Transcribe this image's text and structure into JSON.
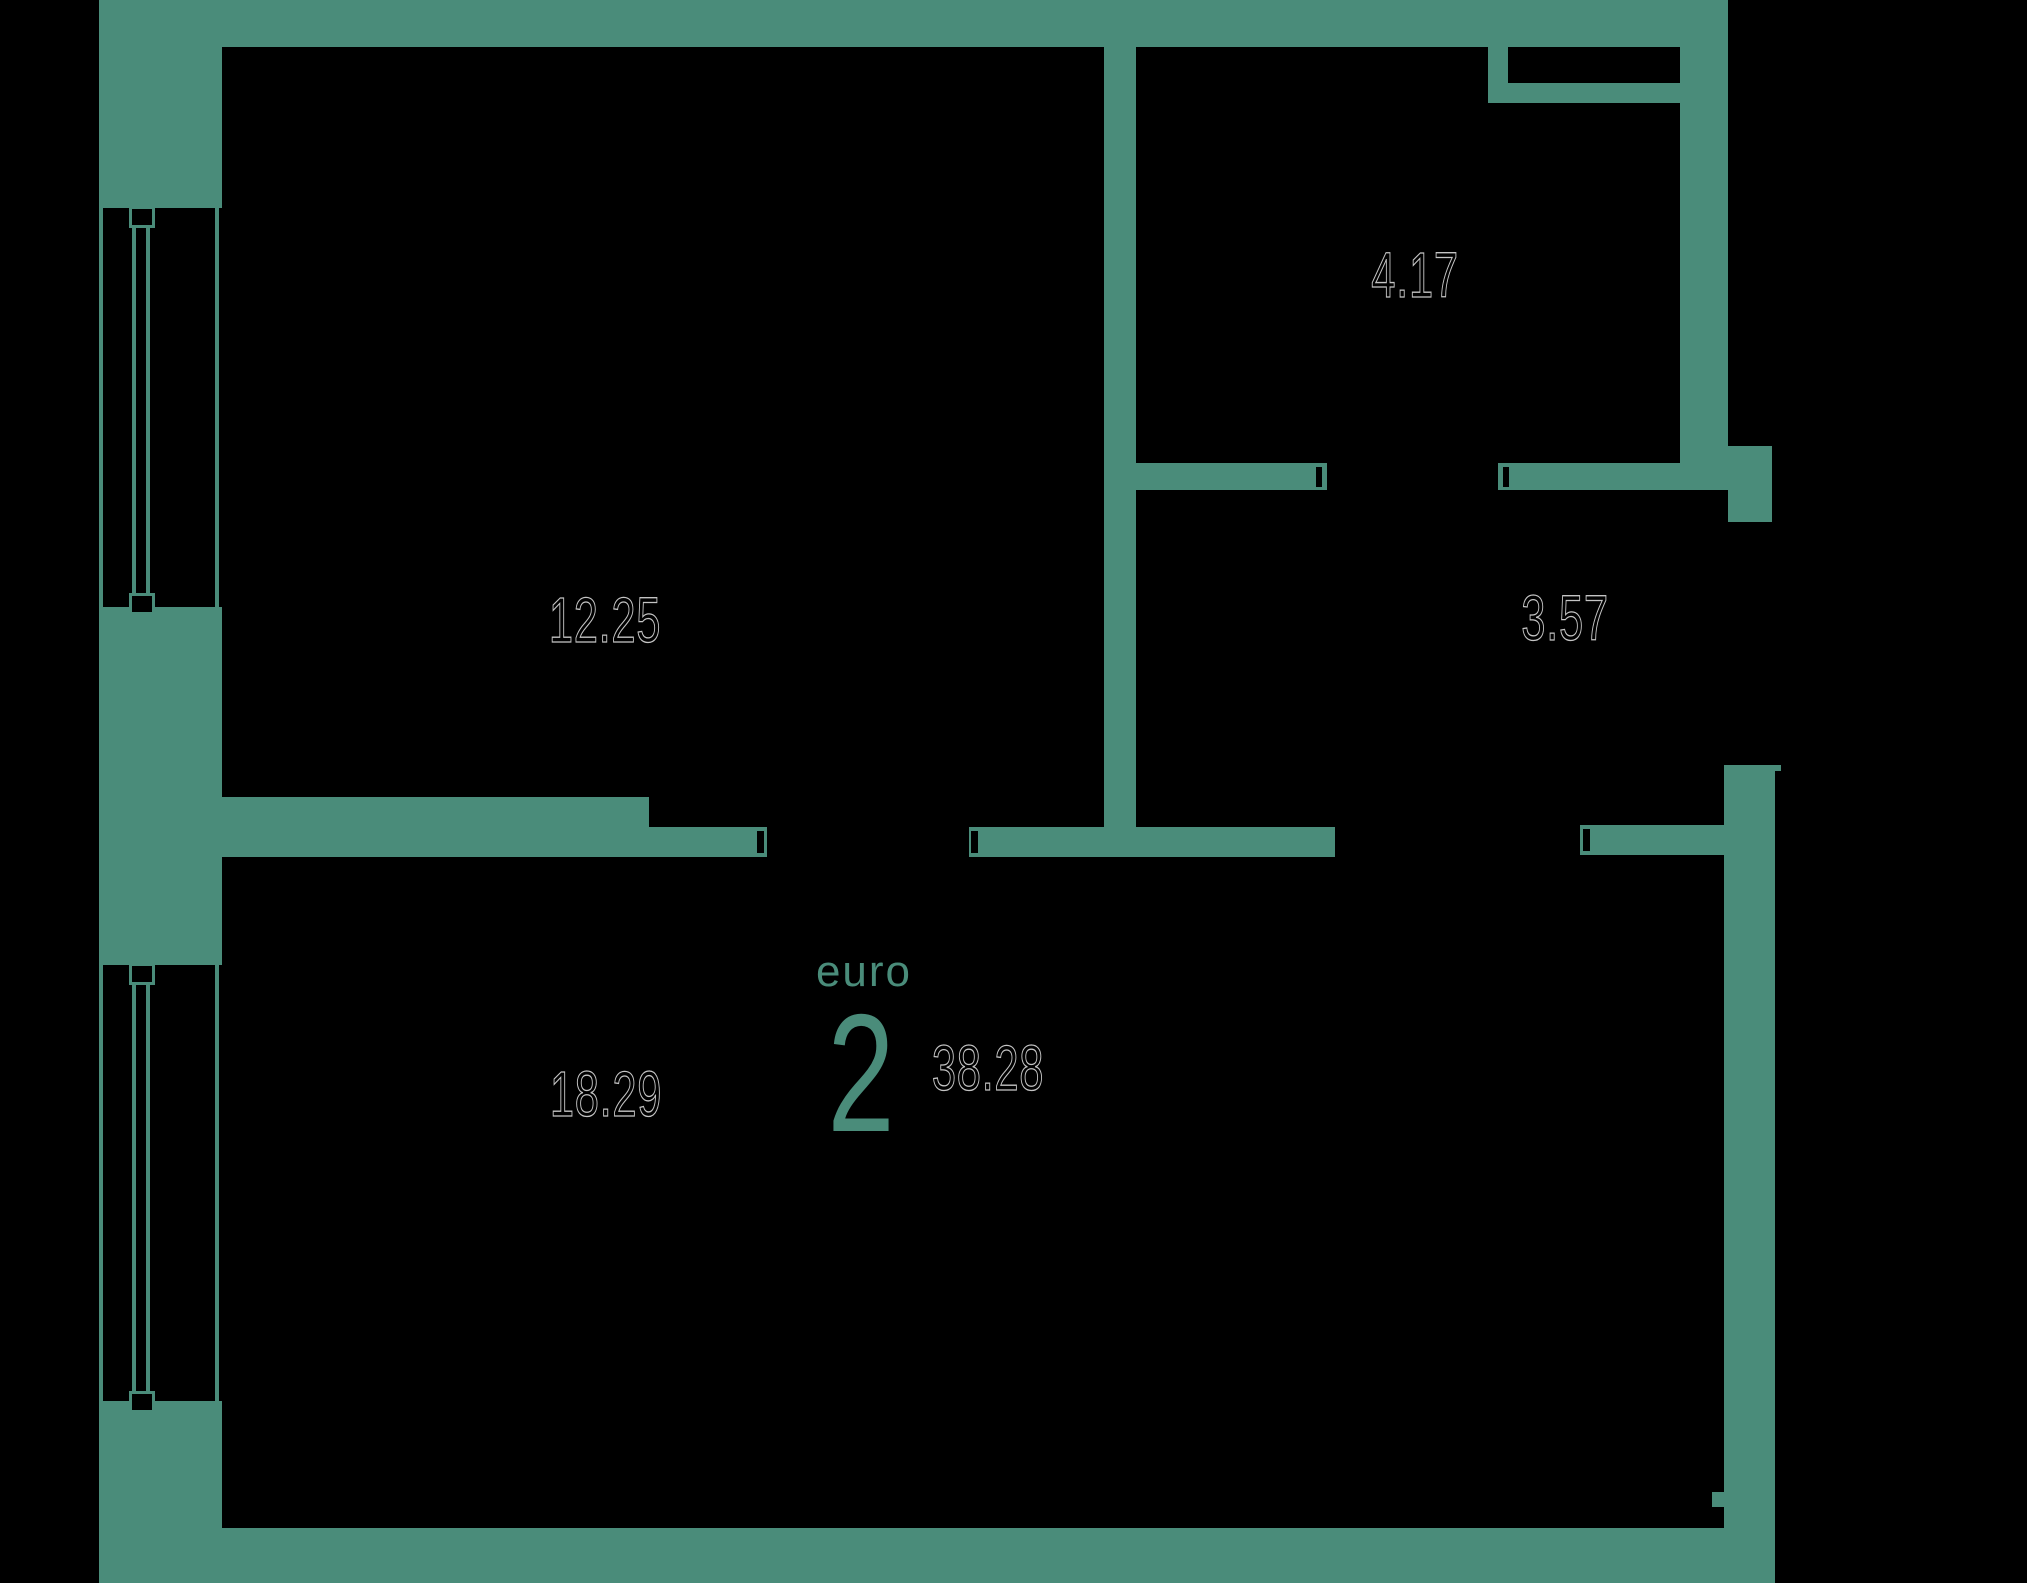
{
  "plan": {
    "colors": {
      "background": "#000000",
      "wall": "#4a8c7a",
      "label_outline": "#c4c4c4",
      "accent": "#4a8c7a"
    },
    "unit": {
      "type_label": "euro",
      "type_number": "2",
      "total_area": "38.28"
    },
    "rooms": [
      {
        "id": "room-top-left",
        "area": "12.25"
      },
      {
        "id": "room-top-right",
        "area": "4.17"
      },
      {
        "id": "room-hall-right",
        "area": "3.57"
      },
      {
        "id": "room-bottom",
        "area": "18.29"
      }
    ]
  }
}
